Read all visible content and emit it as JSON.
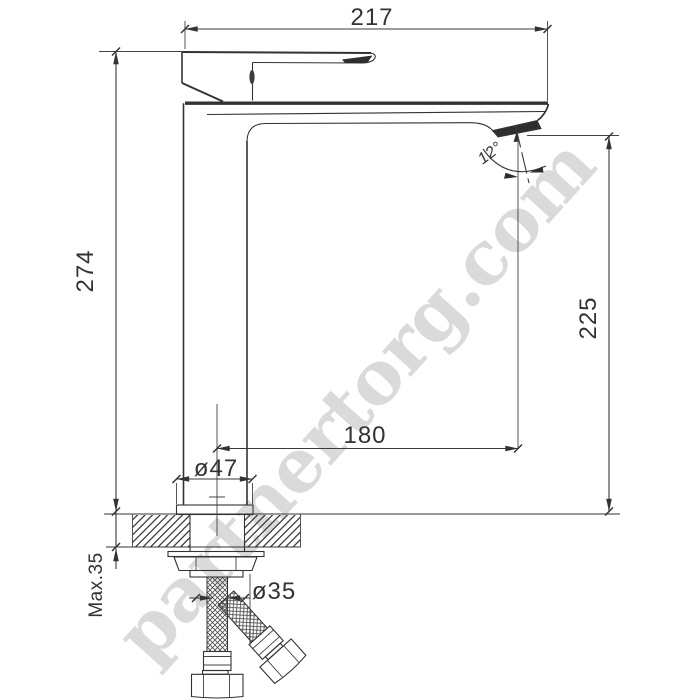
{
  "watermark": {
    "text": "partnertorg.com",
    "color": "#d7d7d7"
  },
  "dimensions": {
    "overall_width": "217",
    "overall_height": "274",
    "spout_height": "225",
    "spout_reach": "180",
    "base_diameter": "ø47",
    "hole_diameter": "ø35",
    "deck_max_thickness": "Max.35",
    "spout_angle": "12°"
  },
  "colors": {
    "line": "#333333",
    "dark_fill": "#2e2e2e",
    "watermark": "#d7d7d7",
    "background": "#ffffff"
  }
}
